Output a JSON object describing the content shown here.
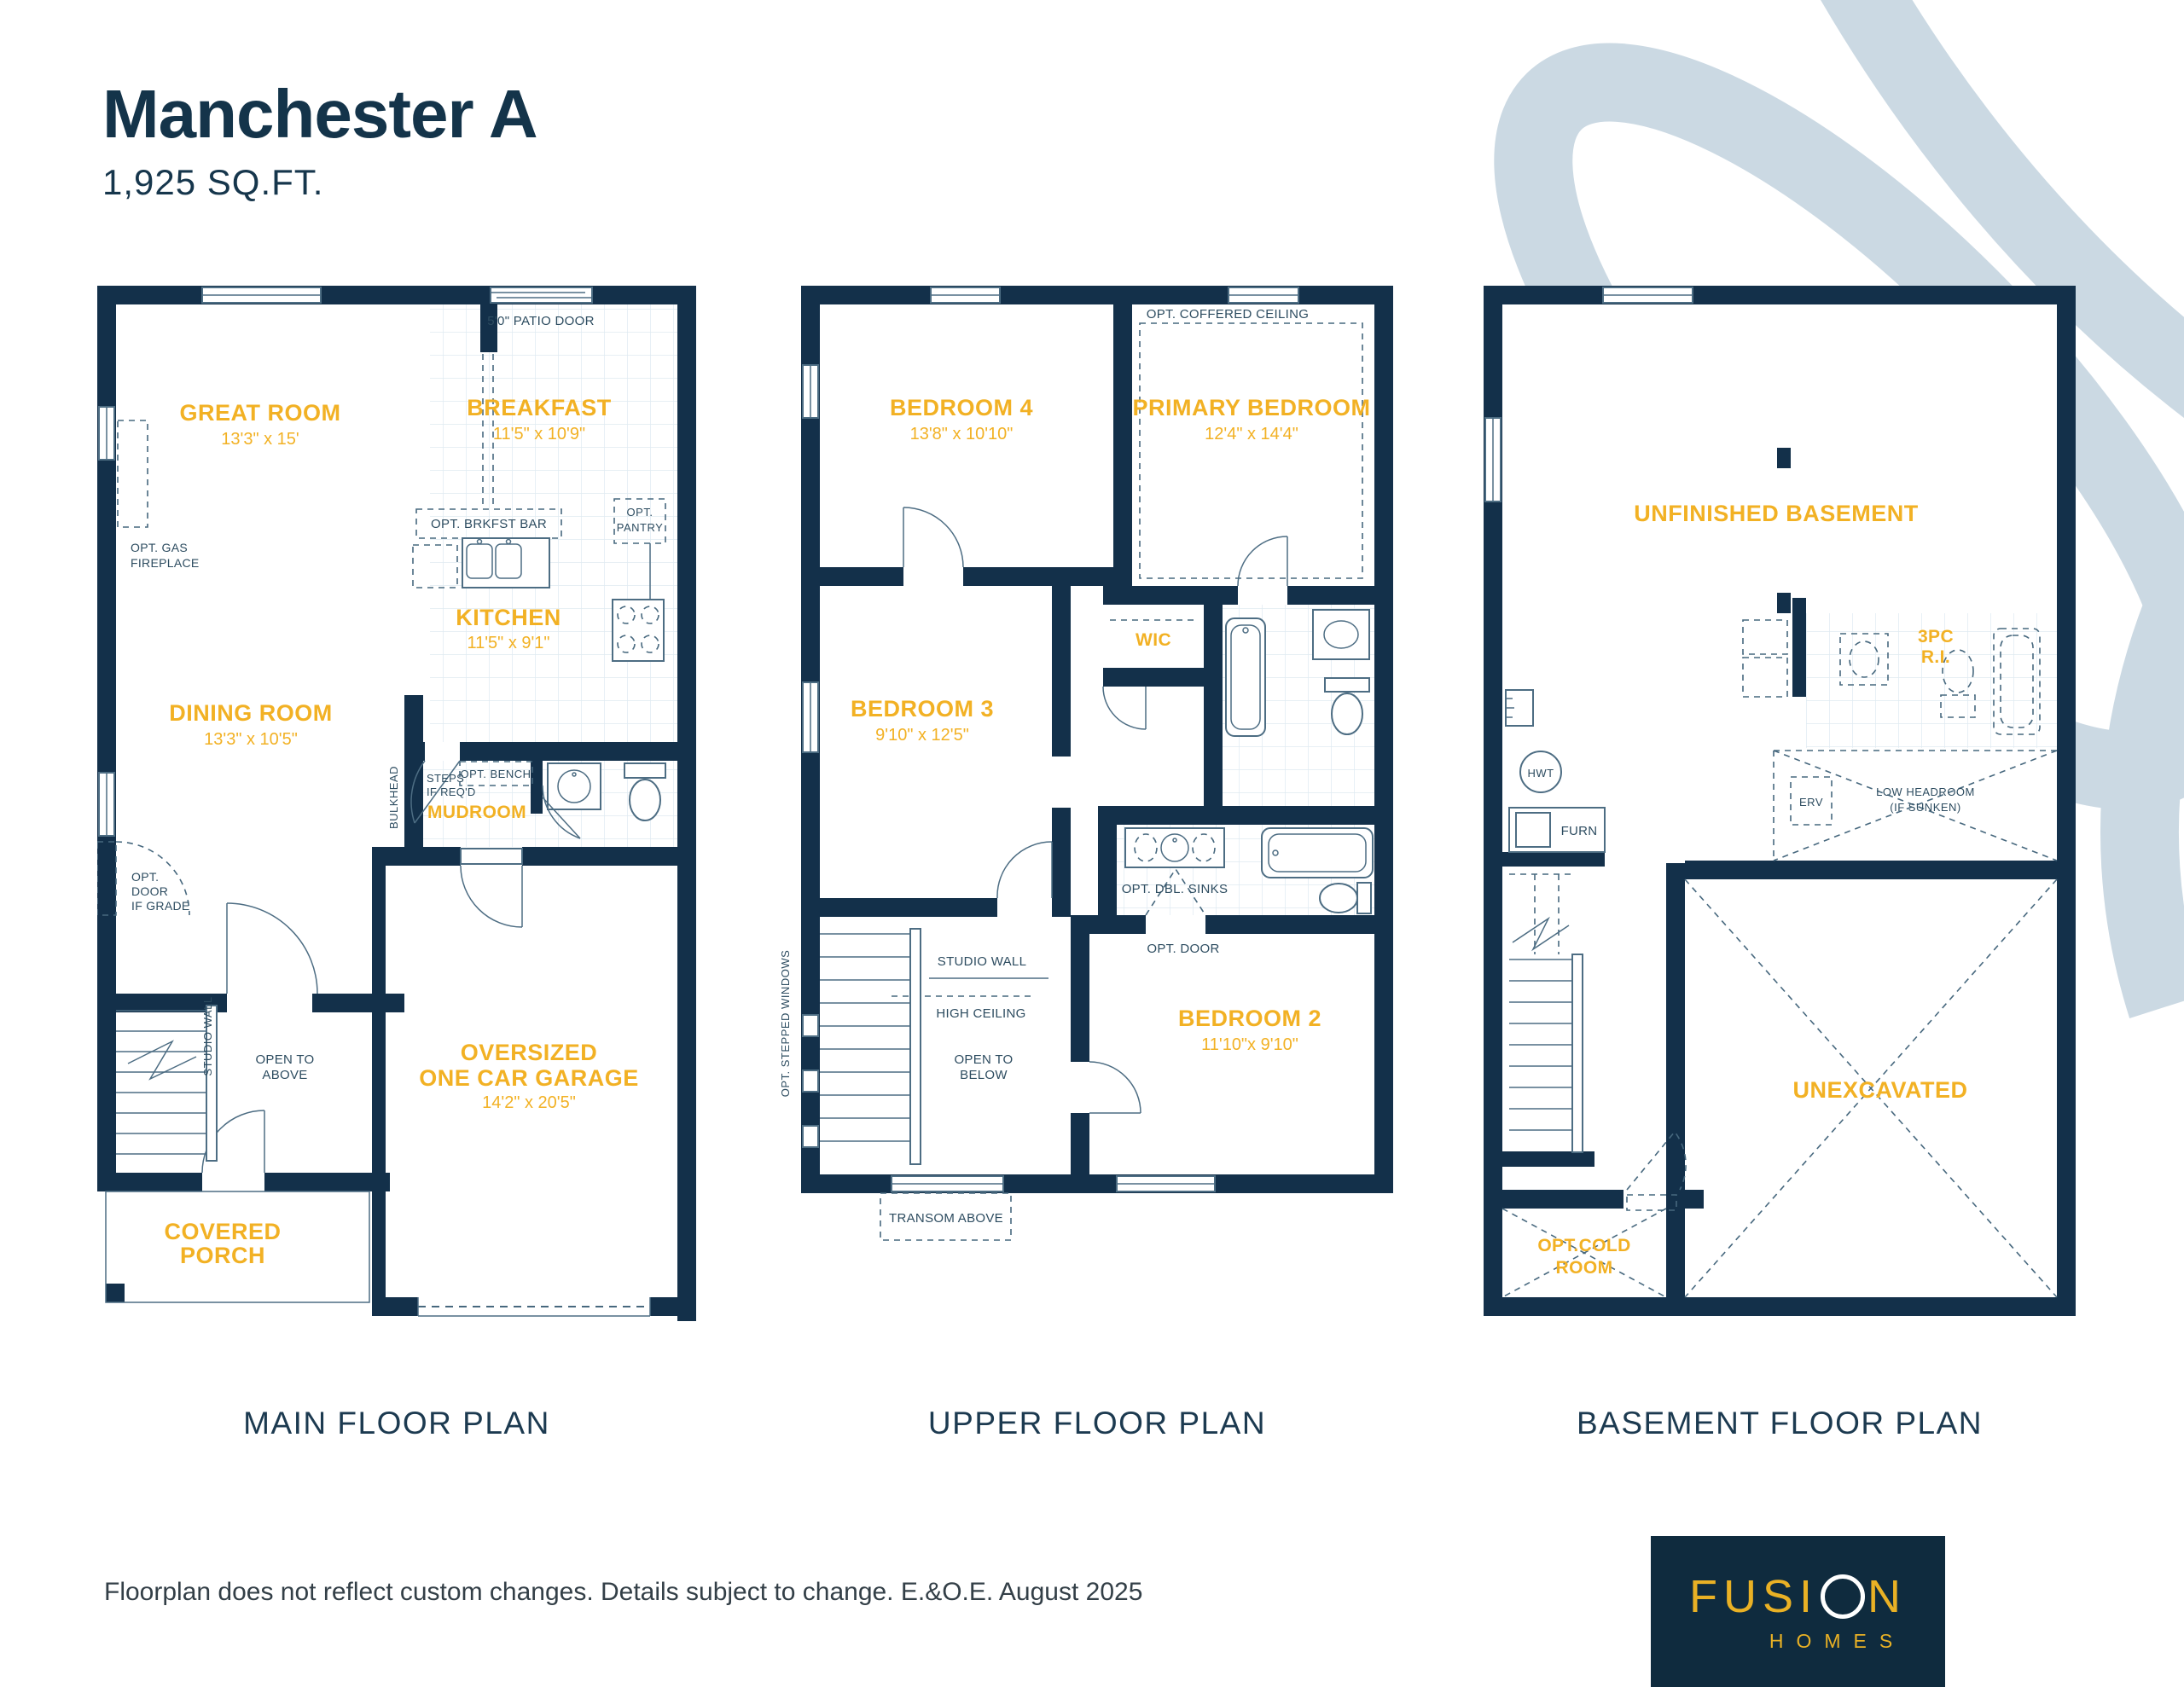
{
  "header": {
    "title": "Manchester A",
    "sqft": "1,925 SQ.FT."
  },
  "plan_titles": {
    "main": "MAIN FLOOR PLAN",
    "upper": "UPPER FLOOR PLAN",
    "basement": "BASEMENT FLOOR PLAN"
  },
  "footer": {
    "disclaimer": "Floorplan does not reflect custom changes. Details subject to change. E.&O.E. August 2025"
  },
  "logo": {
    "brand_pre": "FUSI",
    "brand_post": "N",
    "sub": "HOMES"
  },
  "colors": {
    "navy": "#13304a",
    "gold": "#f2b124",
    "swirl": "#cbd9e3",
    "line": "#4d6d83",
    "note": "#2d4c60"
  },
  "main": {
    "great_room": "GREAT ROOM",
    "great_room_dims": "13'3\" x 15'",
    "breakfast": "BREAKFAST",
    "breakfast_dims": "11'5\" x 10'9\"",
    "kitchen": "KITCHEN",
    "kitchen_dims": "11'5\" x 9'1\"",
    "dining": "DINING ROOM",
    "dining_dims": "13'3\" x 10'5\"",
    "mudroom": "MUDROOM",
    "garage1": "OVERSIZED",
    "garage2": "ONE CAR GARAGE",
    "garage_dims": "14'2\" x 20'5\"",
    "porch1": "COVERED",
    "porch2": "PORCH",
    "patio_door": "5'0\" PATIO DOOR",
    "opt_gas1": "OPT. GAS",
    "opt_gas2": "FIREPLACE",
    "brkfst_bar": "OPT. BRKFST BAR",
    "pantry1": "OPT.",
    "pantry2": "PANTRY",
    "bench": "OPT. BENCH",
    "steps1": "STEPS",
    "steps2": "IF REQ'D",
    "bulkhead": "BULKHEAD",
    "opt_door1": "OPT.",
    "opt_door2": "DOOR",
    "opt_door3": "IF GRADE",
    "studio_wall": "STUDIO WALL",
    "open_above1": "OPEN TO",
    "open_above2": "ABOVE"
  },
  "upper": {
    "bed4": "BEDROOM 4",
    "bed4_dims": "13'8\" x 10'10\"",
    "primary": "PRIMARY BEDROOM",
    "primary_dims": "12'4\" x 14'4\"",
    "coffered": "OPT. COFFERED CEILING",
    "wic": "WIC",
    "bed3": "BEDROOM 3",
    "bed3_dims": "9'10\" x 12'5\"",
    "dbl_sinks": "OPT. DBL. SINKS",
    "opt_door": "OPT. DOOR",
    "studio_wall": "STUDIO WALL",
    "high_ceiling": "HIGH CEILING",
    "open_below1": "OPEN TO",
    "open_below2": "BELOW",
    "bed2": "BEDROOM 2",
    "bed2_dims": "11'10\"x 9'10\"",
    "stepped": "OPT. STEPPED WINDOWS",
    "transom": "TRANSOM ABOVE"
  },
  "basement": {
    "unfinished": "UNFINISHED BASEMENT",
    "rough1": "3PC",
    "rough2": "R.I.",
    "hwt": "HWT",
    "erv": "ERV",
    "furn": "FURN",
    "low1": "LOW HEADROOM",
    "low2": "(IF SUNKEN)",
    "unexcavated": "UNEXCAVATED",
    "cold1": "OPT.COLD",
    "cold2": "ROOM"
  }
}
